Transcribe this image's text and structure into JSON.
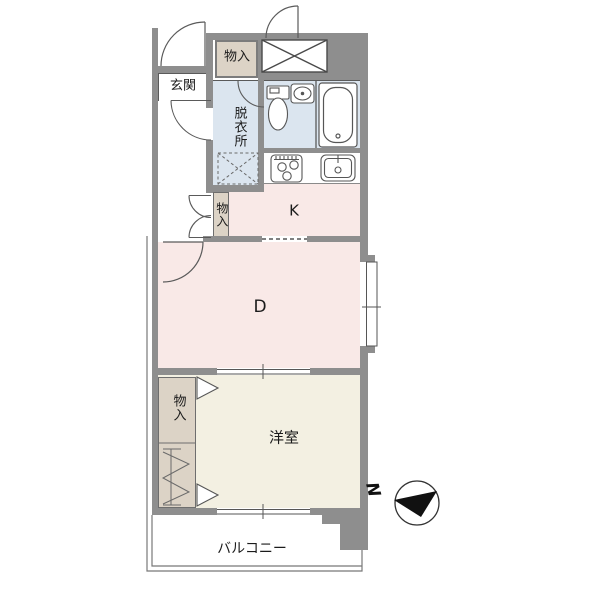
{
  "title": "1DK apartment floor plan",
  "colors": {
    "wall": "#8e8e8e",
    "line": "#565656",
    "room_pink": "#f9e9e7",
    "room_cream": "#f3f0e2",
    "room_blue": "#dbe5ef",
    "closet_tan": "#dcd3c6",
    "outline": "#787878",
    "white": "#ffffff",
    "needle_black": "#111111"
  },
  "rooms": {
    "genkan": {
      "label": "玄関"
    },
    "storage_top": {
      "label": "物入"
    },
    "dressing": {
      "label": "脱衣所"
    },
    "storage_hall": {
      "label": "物入"
    },
    "kitchen": {
      "label": "K"
    },
    "dining": {
      "label": "D"
    },
    "closet": {
      "label": "物入"
    },
    "western_room": {
      "label": "洋室"
    },
    "balcony": {
      "label": "バルコニー"
    }
  },
  "compass": {
    "north_label": "N"
  },
  "icons": [
    "toilet-icon",
    "washbasin-icon",
    "bathtub-icon",
    "stove-icon",
    "kitchen-sink-icon",
    "washer-space-icon",
    "shaft-x-icon",
    "door-swing-icon",
    "folding-door-icon",
    "hanger-pipe-icon",
    "sliding-window-icon",
    "north-arrow-icon"
  ]
}
